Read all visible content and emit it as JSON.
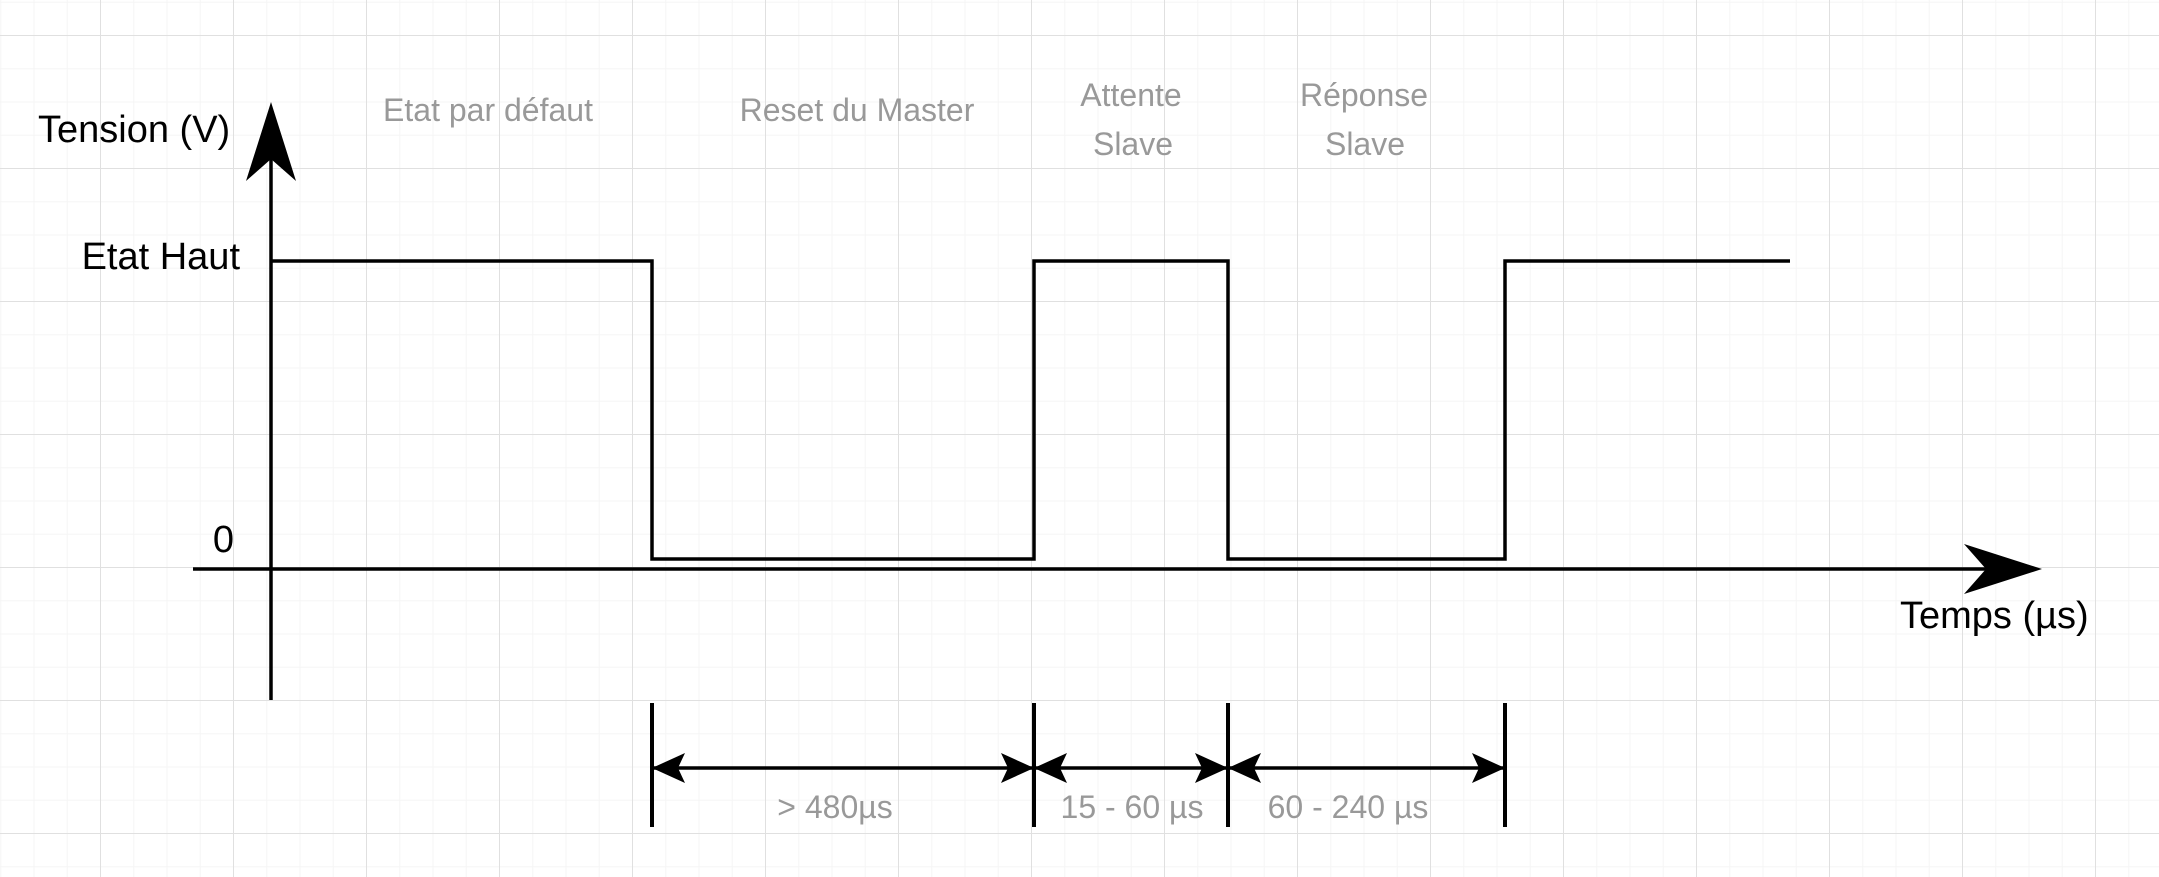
{
  "canvas": {
    "width": 2159,
    "height": 877,
    "background": "#ffffff"
  },
  "colors": {
    "line": "#000000",
    "muted_label": "#999999",
    "grid_minor": "#f5f5f5",
    "grid_major": "#e0e0e0"
  },
  "axes": {
    "y_label": "Tension (V)",
    "x_label": "Temps (µs)",
    "high_level_label": "Etat Haut",
    "origin_label": "0"
  },
  "phases": [
    {
      "lines": [
        "Etat par défaut"
      ],
      "level": "haut",
      "duration": ""
    },
    {
      "lines": [
        "Reset du Master"
      ],
      "level": "bas",
      "duration": "> 480µs"
    },
    {
      "lines": [
        "Attente",
        "Slave"
      ],
      "level": "haut",
      "duration": "15 - 60 µs"
    },
    {
      "lines": [
        "Réponse",
        "Slave"
      ],
      "level": "bas",
      "duration": "60 - 240 µs"
    }
  ],
  "signal": {
    "levels_sequence": [
      "haut",
      "bas",
      "haut",
      "bas",
      "haut"
    ]
  }
}
